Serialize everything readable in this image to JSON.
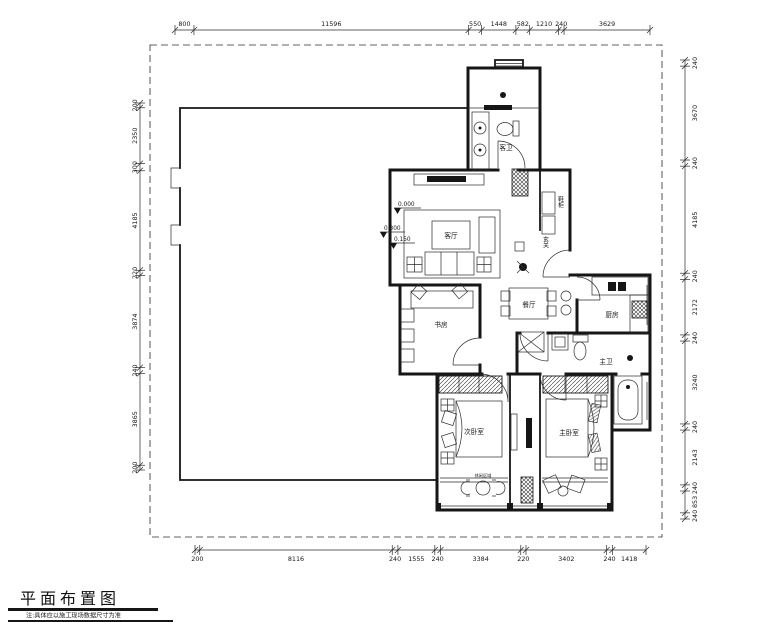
{
  "title_block": {
    "title": "平面布置图",
    "note": "注:具体应以施工现场数据尺寸为准"
  },
  "dimensions": {
    "top": [
      "800",
      "11596",
      "550",
      "1448",
      "582",
      "1210",
      "240",
      "3629"
    ],
    "bottom": [
      "200",
      "8116",
      "240",
      "1555",
      "240",
      "3384",
      "220",
      "3402",
      "240",
      "1418"
    ],
    "left": [
      "200",
      "2350",
      "300",
      "4185",
      "220",
      "3874",
      "240",
      "3865",
      "200"
    ],
    "right": [
      "240",
      "3670",
      "240",
      "4185",
      "240",
      "2172",
      "240",
      "3240",
      "240",
      "2143",
      "240",
      "853",
      "240"
    ]
  },
  "rooms": {
    "guest_bath": "客卫",
    "living": "客厅",
    "entry": "玄关",
    "shoe_cabinet": "鞋柜",
    "dining": "餐厅",
    "kitchen": "厨房",
    "master_bath": "主卫",
    "study": "书房",
    "second_bedroom": "次卧室",
    "master_bedroom": "主卧室",
    "leisure": "休闲区域"
  },
  "elevations": {
    "zero": "0.000",
    "e300": "0.300",
    "e150": "0.150"
  },
  "colors": {
    "line": "#161616",
    "background": "#ffffff"
  }
}
